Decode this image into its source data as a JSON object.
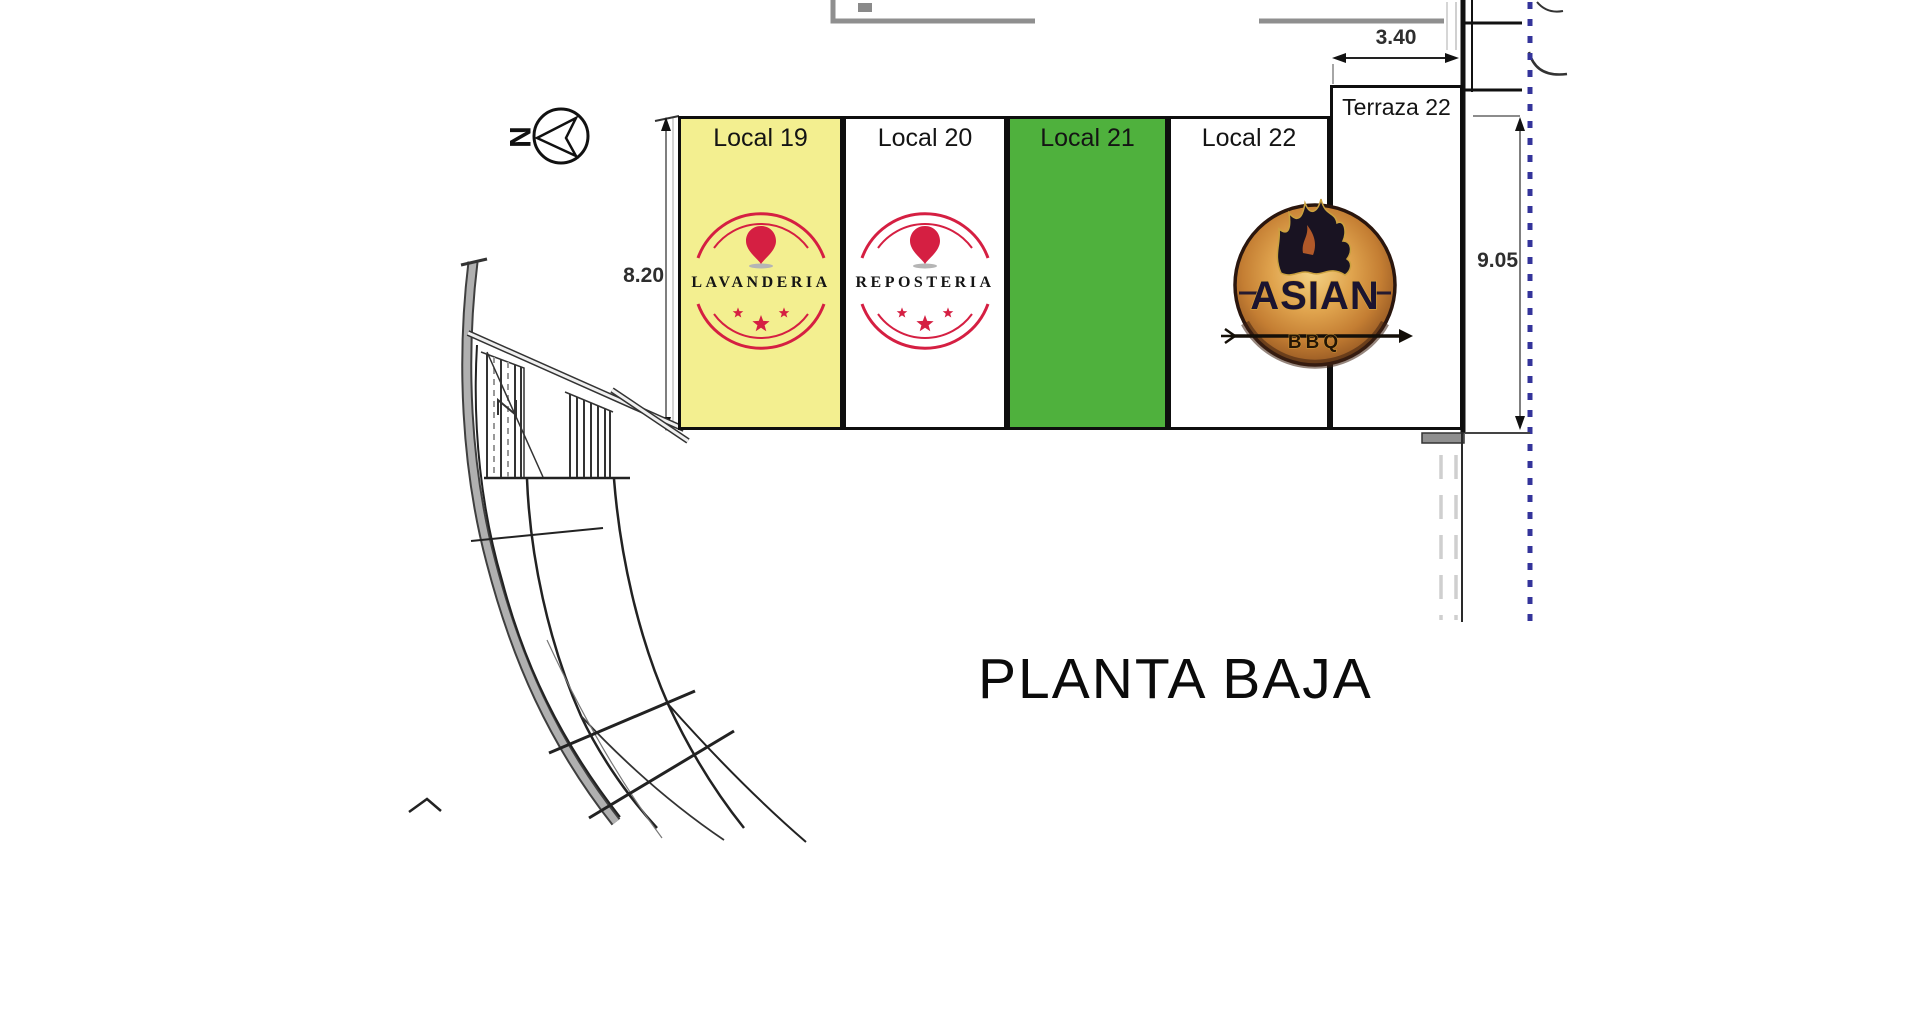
{
  "title": "PLANTA BAJA",
  "compass": {
    "letter": "N"
  },
  "dimensions": {
    "terraza_width": "3.40",
    "locals_height": "8.20",
    "right_height": "9.05"
  },
  "units": [
    {
      "label": "Local 19",
      "fill": "#f3ef90"
    },
    {
      "label": "Local 20",
      "fill": "#ffffff"
    },
    {
      "label": "Local 21",
      "fill": "#4fb13d"
    },
    {
      "label": "Local 22",
      "fill": "#ffffff"
    },
    {
      "label": "Terraza 22",
      "fill": "#ffffff"
    }
  ],
  "stamps": {
    "lavanderia": "LAVANDERIA",
    "reposteria": "REPOSTERIA"
  },
  "asian_logo": {
    "title": "ASIAN",
    "subtitle": "BBQ"
  },
  "colors": {
    "stamp_red": "#d51f42",
    "dotted_blue": "#34349b",
    "local19_yellow": "#f3ef90",
    "local21_green": "#4fb13d"
  }
}
